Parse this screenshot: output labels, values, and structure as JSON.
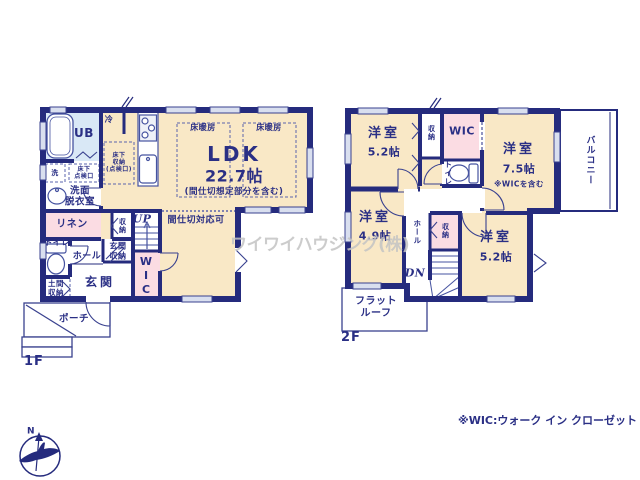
{
  "f1": {
    "floor_label": "1F",
    "bath": "UB",
    "fridge": "冷",
    "washer": "洗",
    "underfloor_hatch": "床下\n点検口",
    "underfloor_storage": "床下\n収納\n(点検口)",
    "washroom": "洗面\n脱衣室",
    "linen": "リネン",
    "toilet": "トイレ",
    "hall": "ホール",
    "entrance_storage": "玄関\n収納",
    "entrance": "玄関",
    "doma_storage": "土間\n収納",
    "closet": "収納",
    "stairs_up": "UP",
    "wic": "WIC",
    "porch": "ポーチ",
    "ldk": {
      "name": "LDK",
      "size": "22.7帖",
      "note": "(間仕切想定部分を含む)"
    },
    "floor_heating_left": "床暖房",
    "floor_heating_right": "床暖房",
    "partition_note": "間仕切対応可"
  },
  "f2": {
    "floor_label": "2F",
    "room_nw": {
      "name": "洋室",
      "size": "5.2帖"
    },
    "room_ne": {
      "name": "洋室",
      "size": "7.5帖",
      "note": "※WICを含む"
    },
    "room_sw": {
      "name": "洋室",
      "size": "4.9帖"
    },
    "room_se": {
      "name": "洋室",
      "size": "5.2帖"
    },
    "closet_top": "収納",
    "closet_mid": "収納",
    "wic": "WIC",
    "toilet": "トイレ",
    "hall": "ホール",
    "stairs_down": "DN",
    "balcony": "バルコニー",
    "flat_roof": "フラット\nルーフ"
  },
  "annotations": {
    "watermark": "ワイワイハウジング(株)",
    "wic_legend": "※WIC:ウォーク イン クローゼット",
    "compass_north": "N"
  },
  "colors": {
    "wall": "#252b7d",
    "text": "#2a2f85",
    "room_cream": "#f9e8c6",
    "room_pink": "#fbdce3",
    "bath_blue": "#d9e8f6",
    "window_fill": "#d9dfef",
    "watermark": "#c4c4c4"
  }
}
